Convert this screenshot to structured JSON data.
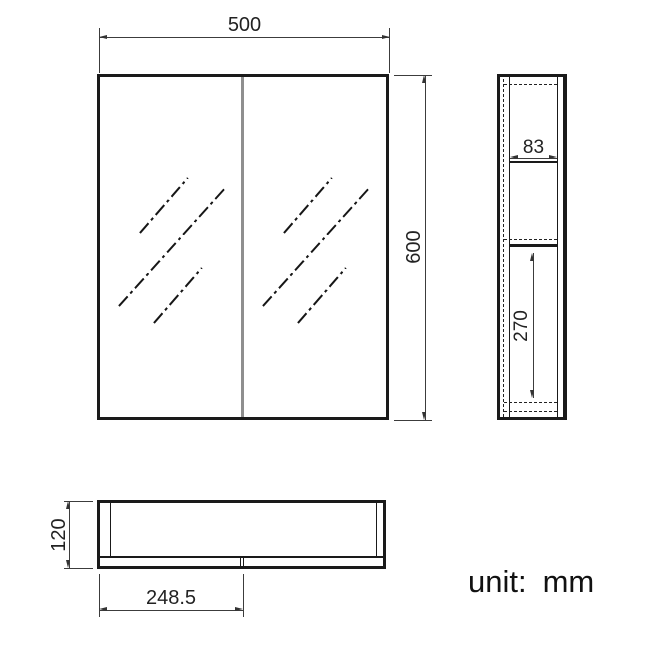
{
  "unit_note": {
    "prefix": "unit:",
    "value": "mm"
  },
  "dimensions": {
    "front_width": "500",
    "front_height": "600",
    "side_inner_depth": "83",
    "side_shelf_height": "270",
    "bottom_depth": "120",
    "bottom_door_width": "248.5"
  },
  "colors": {
    "drawing_line": "#1a1a1a",
    "dimension_line": "#3c3c3c",
    "door_divider": "#8f8f8f",
    "background": "#ffffff"
  }
}
